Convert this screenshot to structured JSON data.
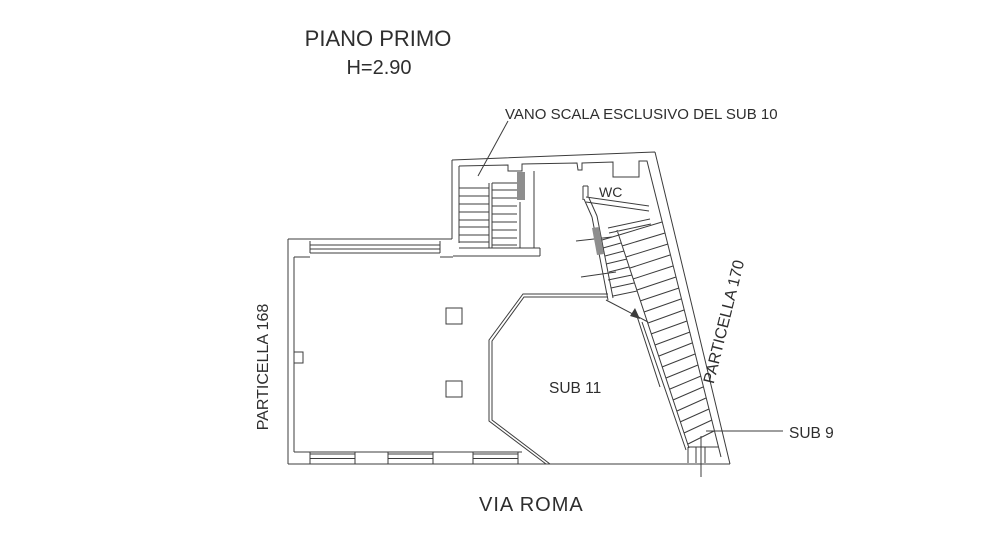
{
  "colors": {
    "line": "#3c3c3c",
    "text": "#2e2e2e",
    "gray_fill": "#8e8e8e",
    "background": "#ffffff"
  },
  "title": {
    "main": "PIANO PRIMO",
    "height": "H=2.90"
  },
  "labels": {
    "stair_note": "VANO SCALA ESCLUSIVO DEL SUB 10",
    "wc": "WC",
    "sub11": "SUB 11",
    "sub9": "SUB 9",
    "particella_left": "PARTICELLA 168",
    "particella_right": "PARTICELLA 170",
    "street": "VIA ROMA"
  }
}
